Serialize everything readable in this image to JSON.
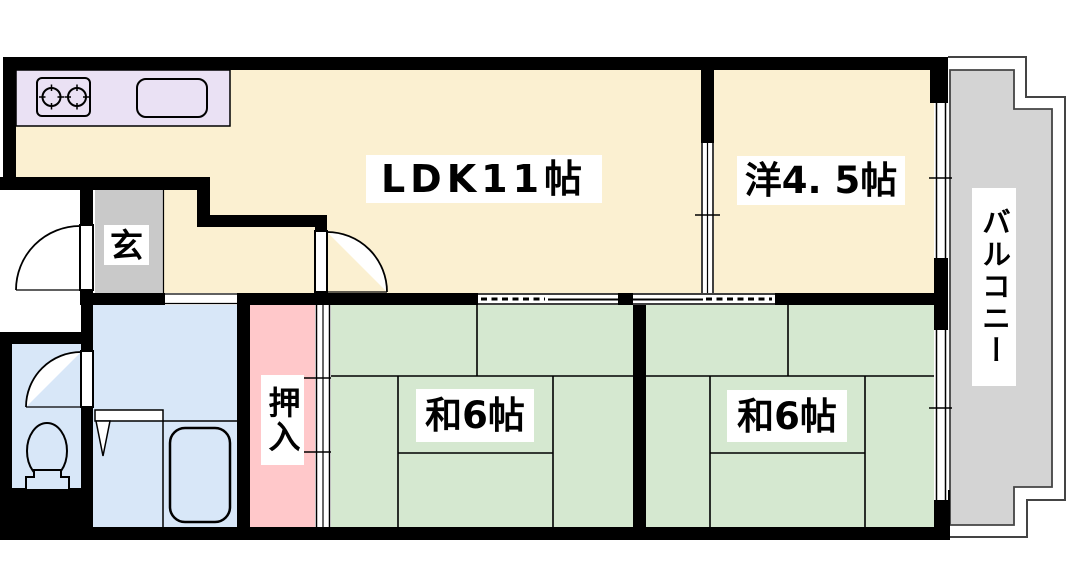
{
  "floor_plan": {
    "rooms": {
      "ldk": {
        "label": "LDK11帖"
      },
      "western_room": {
        "label": "洋4. 5帖"
      },
      "japanese_room_1": {
        "label": "和6帖"
      },
      "japanese_room_2": {
        "label": "和6帖"
      },
      "balcony": {
        "label": "バルコニー"
      },
      "entrance": {
        "label": "玄"
      },
      "closet": {
        "label": "押入"
      }
    },
    "colors": {
      "wall": "#000000",
      "ldk_floor": "#FBF0D1",
      "western_room_floor": "#FBF0D1",
      "tatami_floor": "#D5E8D0",
      "sanitary_floor": "#D8E7F8",
      "closet_floor": "#FFC8CA",
      "kitchen_counter": "#EAE1F4",
      "entrance_floor": "#C9C9C9",
      "balcony_floor": "#D4D4D4",
      "label_background": "#FFFFFF",
      "label_text": "#000000"
    },
    "icons": {
      "stove": "two-burner-stove-icon",
      "sink": "kitchen-sink-icon",
      "toilet": "toilet-icon",
      "bathtub": "bathtub-icon"
    }
  }
}
